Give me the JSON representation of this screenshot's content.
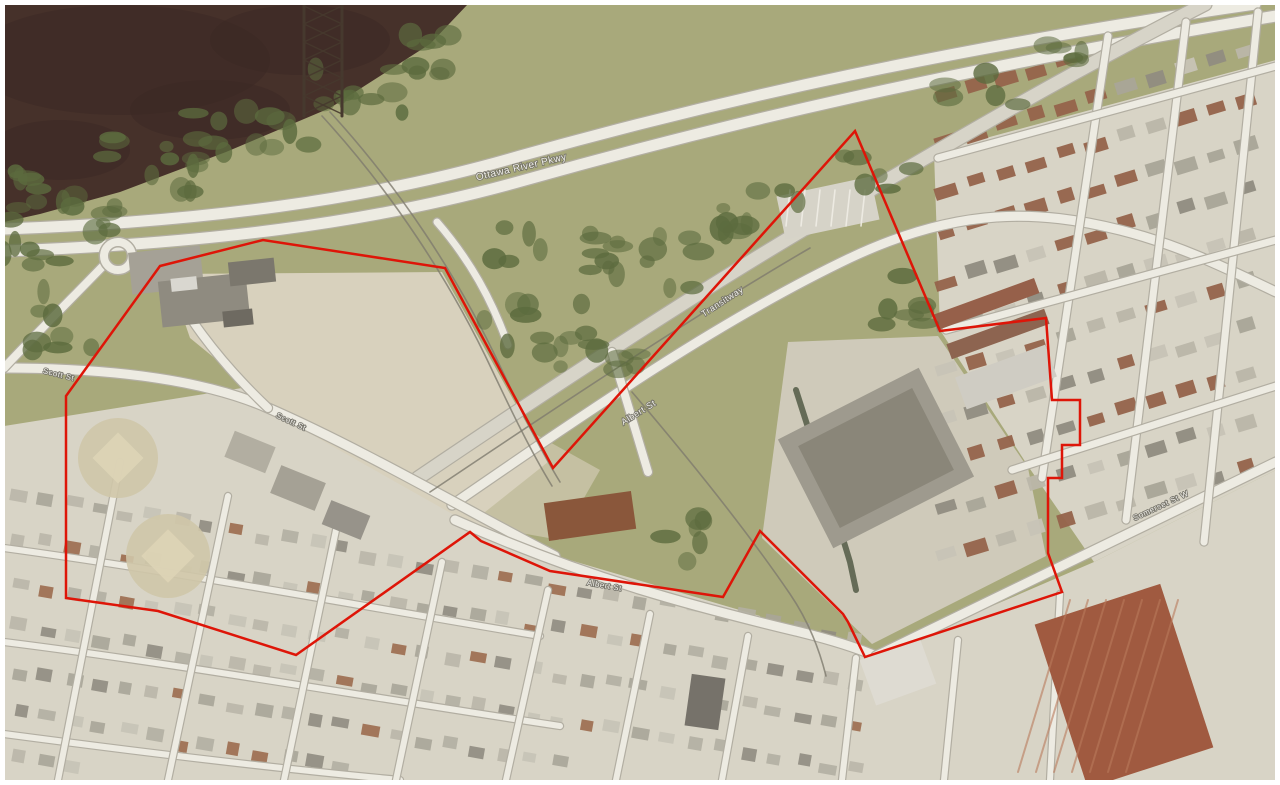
{
  "map": {
    "kind": "aerial-photo-with-site-boundary",
    "road_labels": [
      {
        "text": "Ottawa River Pkwy",
        "x": 522,
        "y": 170,
        "rotate": -13,
        "size": 10
      },
      {
        "text": "Transitway",
        "x": 724,
        "y": 304,
        "rotate": -33,
        "size": 9
      },
      {
        "text": "Albert St",
        "x": 640,
        "y": 415,
        "rotate": -32,
        "size": 9
      },
      {
        "text": "Scott St",
        "x": 290,
        "y": 424,
        "rotate": 25,
        "size": 8
      },
      {
        "text": "Scott St",
        "x": 58,
        "y": 377,
        "rotate": 14,
        "size": 8
      },
      {
        "text": "Albert St",
        "x": 604,
        "y": 588,
        "rotate": 10,
        "size": 8
      },
      {
        "text": "Somerset St W",
        "x": 1162,
        "y": 508,
        "rotate": -25,
        "size": 8
      }
    ],
    "site_boundary": {
      "color": "#de1508",
      "stroke_width": 2.5,
      "points": "160,266 263,240 445,268 553,468 855,131 940,331 1046,318 1052,400 1080,400 1080,445 1062,445 1062,478 1048,478 1048,553 1062,592 865,657 848,622 843,614 760,531 723,597 550,571 481,541 470,532 296,655 158,611 66,598 66,396"
    },
    "colors": {
      "river": "#46312a",
      "river_dark": "#392823",
      "park": "#a6a778",
      "park_light": "#b1b083",
      "tree": "#5c6b3e",
      "urban": "#d8d4c6",
      "dirt": "#d8d1bd",
      "road": "#edebe2",
      "road_casing": "#b2aea2",
      "transit_road": "#d7d4c8",
      "rail": "#7e7a6e",
      "aqueduct": "#525a45",
      "boundary_red": "#de1508",
      "frame": "#ffffff"
    }
  }
}
